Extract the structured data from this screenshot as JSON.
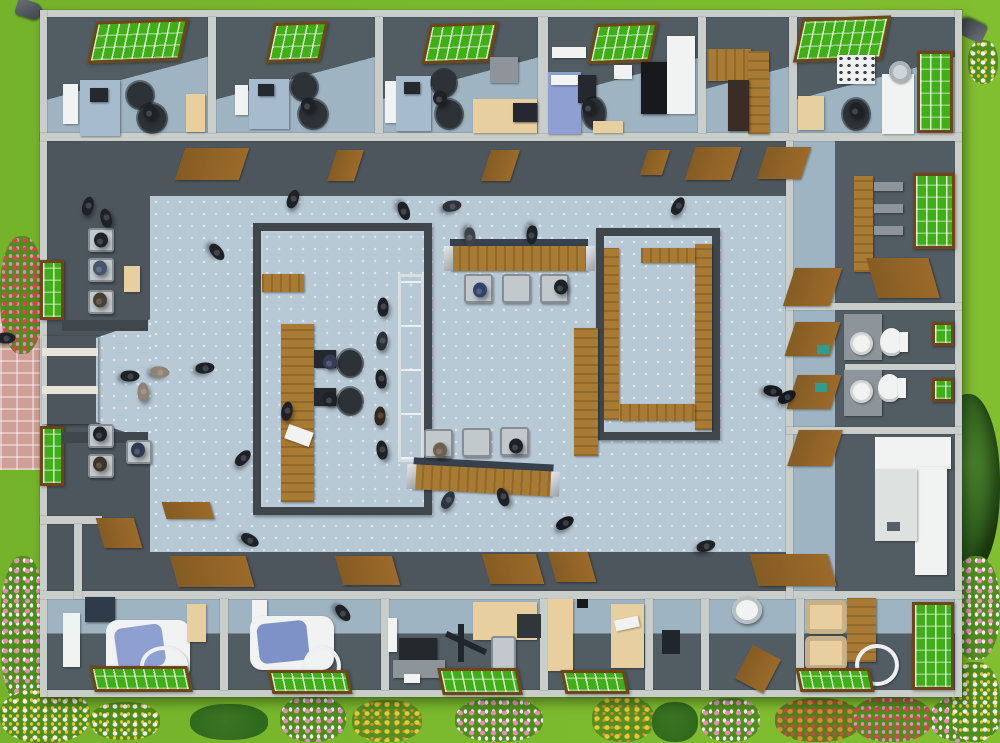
{
  "palette": {
    "grass": "#74b32a",
    "grass_edge": "#81bf31",
    "flowerbed": "#5d9a22",
    "wall_light": "#c9cecb",
    "wall_face": "#4d565d",
    "wall_dark": "#3f474d",
    "room_floor": "#525c63",
    "room_floor_blue": "#9fb4c2",
    "hall_floor": "#b8c9d6",
    "wood": "#a87a33",
    "wood_dark": "#855c24",
    "door_brown": "#9b6a2a",
    "window_green": "#3fae17",
    "frame_brown": "#6f4519",
    "beige": "#e7cfa0",
    "desk_blue": "#a7bbcf",
    "white": "#f1f3f2",
    "equip_dark": "#25292e",
    "chair_gray": "#c2c8cb",
    "glass_blue": "#c3d8e2",
    "brick": "#cf9f97",
    "tree_green": "#2b5a1a",
    "teal": "#2e9d8f",
    "exam_blue": "#8e9fd2",
    "person_dark": "#1e2227",
    "flower_pink": "#e88db8",
    "flower_red": "#d5454a",
    "flower_yellow": "#e9c83a",
    "flower_white": "#f2f2ee",
    "flower_orange": "#d98a35",
    "bush_green": "#2e6a1d"
  },
  "scene": {
    "description": "top-down 3d floor plan of a clinic building surrounded by lawn and flower beds",
    "people_count": 46,
    "rooms": [
      {
        "name": "office-top-1",
        "items": [
          "skylight-window",
          "wall-monitor",
          "desk",
          "office-chairs",
          "side-table"
        ]
      },
      {
        "name": "office-top-2",
        "items": [
          "skylight-window",
          "wall-monitor",
          "desk",
          "office-chairs"
        ]
      },
      {
        "name": "office-top-3",
        "items": [
          "skylight-window",
          "desk",
          "office-chairs",
          "computer-desk",
          "radiator"
        ]
      },
      {
        "name": "exam-room-top",
        "items": [
          "skylight-window",
          "exam-bed",
          "equipment",
          "cabinet-black",
          "cabinet-white"
        ]
      },
      {
        "name": "storage-room",
        "items": [
          "wood-cabinet",
          "wardrobe",
          "shelf"
        ]
      },
      {
        "name": "lab-room-top-right",
        "items": [
          "skylight-window",
          "appliance",
          "exam-unit",
          "lamp",
          "window"
        ]
      },
      {
        "name": "entrance-waiting",
        "items": [
          "double-door",
          "windows",
          "bench-seats",
          "side-table"
        ]
      },
      {
        "name": "registration-room",
        "items": [
          "service-desk",
          "computers",
          "glass-partition",
          "queue"
        ]
      },
      {
        "name": "reception-counters",
        "items": [
          "wood-counter-top",
          "wood-counter-bottom",
          "visitor-chairs"
        ]
      },
      {
        "name": "bench-waiting-room",
        "items": [
          "wall-benches"
        ]
      },
      {
        "name": "shelf-room-right",
        "items": [
          "shelving-unit",
          "window",
          "door"
        ]
      },
      {
        "name": "toilets",
        "items": [
          "sinks",
          "toilets",
          "small-windows"
        ]
      },
      {
        "name": "sterilization-room",
        "items": [
          "white-cabinets",
          "faucet"
        ]
      },
      {
        "name": "dental-op-1",
        "items": [
          "dental-chair",
          "tray-arm",
          "equipment-panel",
          "skylight-window"
        ]
      },
      {
        "name": "dental-op-2",
        "items": [
          "dental-chair",
          "tray-arm",
          "lamp-arm",
          "skylight-window"
        ]
      },
      {
        "name": "xray-office",
        "items": [
          "monitor-desk",
          "xray-arm",
          "computer-desk",
          "chair",
          "skylight-window"
        ]
      },
      {
        "name": "office-bottom",
        "items": [
          "wardrobe",
          "paper-desk",
          "skylight-window"
        ]
      },
      {
        "name": "utility-room",
        "items": [
          "equipment"
        ]
      },
      {
        "name": "device-room",
        "items": [
          "round-device",
          "door-leaf"
        ]
      },
      {
        "name": "lounge-bottom-right",
        "items": [
          "armchairs",
          "desk",
          "tray-arm",
          "windows"
        ]
      }
    ],
    "people": [
      {
        "x": 88,
        "y": 206,
        "r": 15
      },
      {
        "x": 106,
        "y": 218,
        "r": -12
      },
      {
        "x": 101,
        "y": 240,
        "seated": true
      },
      {
        "x": 100,
        "y": 268,
        "seated": true,
        "c": "#44566b"
      },
      {
        "x": 100,
        "y": 300,
        "seated": true,
        "c": "#4a3e33"
      },
      {
        "x": 143,
        "y": 392,
        "r": 0,
        "c": "#8d8273"
      },
      {
        "x": 100,
        "y": 434,
        "seated": true
      },
      {
        "x": 100,
        "y": 464,
        "seated": true,
        "c": "#3e3429"
      },
      {
        "x": 138,
        "y": 450,
        "seated": true,
        "c": "#2d3a52"
      },
      {
        "x": 160,
        "y": 372,
        "r": 95,
        "c": "#8d8273"
      },
      {
        "x": 205,
        "y": 368,
        "r": 85
      },
      {
        "x": 130,
        "y": 376,
        "r": 90
      },
      {
        "x": 6,
        "y": 338,
        "r": 90
      },
      {
        "x": 217,
        "y": 252,
        "r": 140
      },
      {
        "x": 293,
        "y": 199,
        "r": 20
      },
      {
        "x": 404,
        "y": 211,
        "r": 160
      },
      {
        "x": 452,
        "y": 206,
        "r": 80,
        "c": "#2e3338"
      },
      {
        "x": 470,
        "y": 237,
        "r": 175,
        "c": "#3c4247"
      },
      {
        "x": 532,
        "y": 235,
        "r": 185
      },
      {
        "x": 678,
        "y": 206,
        "r": 30
      },
      {
        "x": 480,
        "y": 290,
        "seated": true,
        "c": "#31436b"
      },
      {
        "x": 561,
        "y": 287,
        "seated": true
      },
      {
        "x": 330,
        "y": 362,
        "seated": true,
        "c": "#353b58"
      },
      {
        "x": 330,
        "y": 399,
        "seated": true
      },
      {
        "x": 287,
        "y": 411,
        "r": 10
      },
      {
        "x": 383,
        "y": 307,
        "r": 0
      },
      {
        "x": 382,
        "y": 341,
        "r": 8,
        "c": "#2b3037"
      },
      {
        "x": 381,
        "y": 379,
        "r": -6
      },
      {
        "x": 380,
        "y": 416,
        "r": 4,
        "c": "#31271f"
      },
      {
        "x": 382,
        "y": 450,
        "r": -8
      },
      {
        "x": 440,
        "y": 450,
        "seated": true,
        "c": "#6e5f4e"
      },
      {
        "x": 516,
        "y": 446,
        "seated": true
      },
      {
        "x": 448,
        "y": 500,
        "r": 30,
        "c": "#2c3440"
      },
      {
        "x": 503,
        "y": 497,
        "r": -20
      },
      {
        "x": 565,
        "y": 523,
        "r": 60,
        "c": "#15181c"
      },
      {
        "x": 706,
        "y": 546,
        "r": 75
      },
      {
        "x": 250,
        "y": 540,
        "r": 120
      },
      {
        "x": 243,
        "y": 458,
        "r": 45
      },
      {
        "x": 773,
        "y": 391,
        "r": 100,
        "c": "#15181c"
      },
      {
        "x": 787,
        "y": 397,
        "r": 60,
        "c": "#15181c"
      },
      {
        "x": 150,
        "y": 112,
        "seated": true
      },
      {
        "x": 308,
        "y": 105,
        "seated": true
      },
      {
        "x": 440,
        "y": 98,
        "seated": true
      },
      {
        "x": 589,
        "y": 107,
        "seated": true
      },
      {
        "x": 856,
        "y": 110,
        "seated": true
      },
      {
        "x": 343,
        "y": 613,
        "r": 140
      }
    ]
  }
}
